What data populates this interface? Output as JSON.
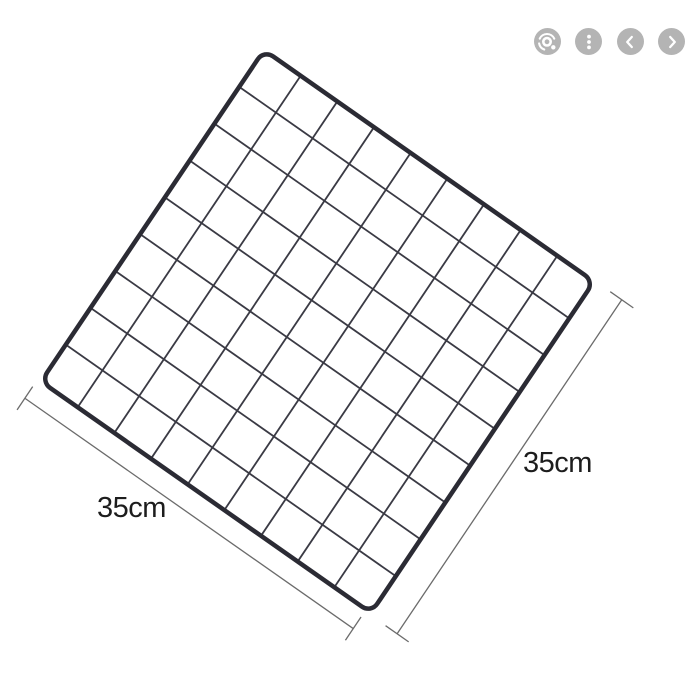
{
  "viewer": {
    "toolbar": {
      "button_bg": "#b4b4b4",
      "glyph_color": "#ffffff",
      "buttons": [
        {
          "name": "visual-search",
          "icon": "lens-icon"
        },
        {
          "name": "more-options",
          "icon": "kebab-menu-icon"
        },
        {
          "name": "previous-image",
          "icon": "chevron-left-icon"
        },
        {
          "name": "next-image",
          "icon": "chevron-right-icon"
        }
      ]
    }
  },
  "product_diagram": {
    "type": "wire-grid-panel",
    "background": "#ffffff",
    "grid": {
      "rows": 9,
      "cols": 9,
      "frame_color": "#2b2b34",
      "wire_color": "#3a3a44",
      "frame_stroke": 4.5,
      "wire_stroke": 1.8,
      "corner_radius": 11
    },
    "dimensions": {
      "bottom_label": "35cm",
      "right_label": "35cm",
      "line_color": "#6b6b6b",
      "line_stroke": 1.3,
      "label_color": "#1d1d1d"
    }
  }
}
